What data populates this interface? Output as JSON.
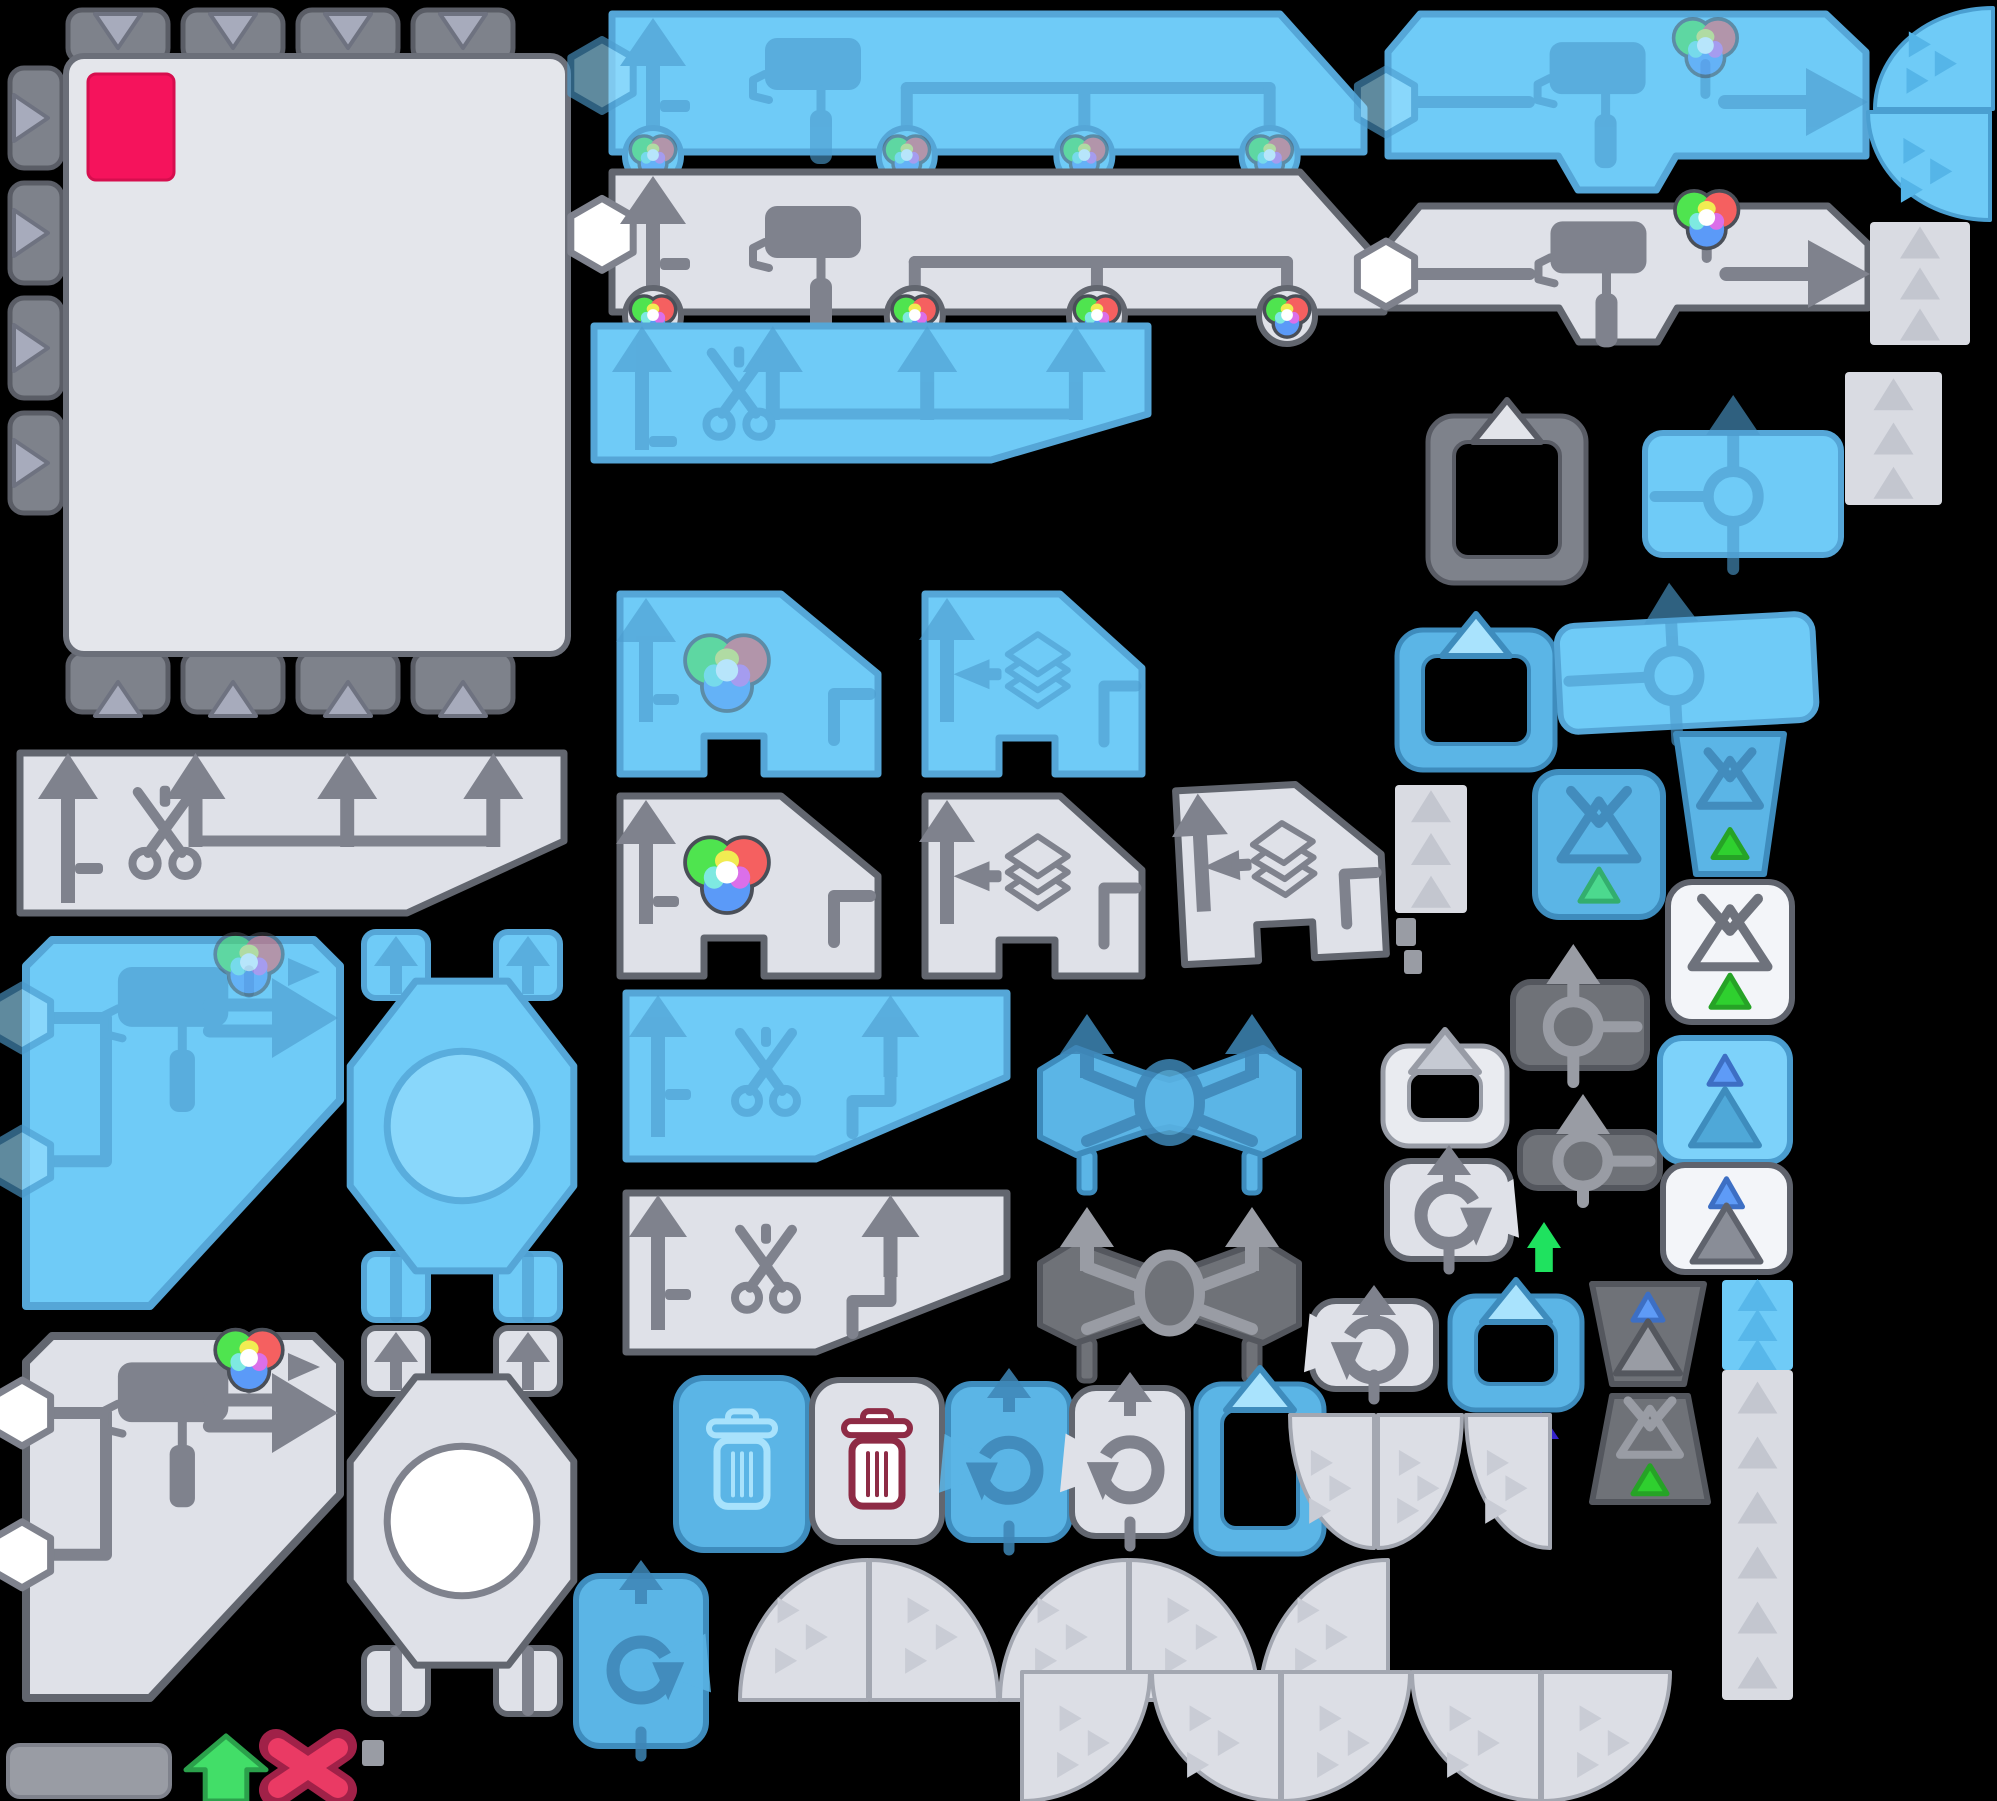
{
  "meta": {
    "kind": "game-ui-sprite-atlas",
    "width": 1997,
    "height": 1801,
    "background": "#000000"
  },
  "palette": {
    "background": "#000000",
    "pink_swatch": "#F5135C",
    "schemes": {
      "blue": {
        "f": "#6FCBF7",
        "s": "#55A6D7",
        "i": "#4C9CCE",
        "lt": "#9ADFFF",
        "iop": 0.62
      },
      "blueMid": {
        "f": "#5BB5E6",
        "s": "#3E8CBD",
        "i": "#3E86B6",
        "lt": "#A9E3FD",
        "iop": 0.85
      },
      "gray": {
        "f": "#DFE1E8",
        "s": "#62666F",
        "i": "#7F828D",
        "lt": "#FFFFFF",
        "iop": 1
      },
      "dark": {
        "f": "#6F7278",
        "s": "#54575E",
        "i": "#999CA4",
        "lt": "#C9CCD3",
        "iop": 1
      },
      "white": {
        "f": "#F3F5F9",
        "s": "#5F636D",
        "i": "#6E727C",
        "lt": "#FFFFFF",
        "iop": 1
      },
      "light": {
        "f": "#E9EBF0",
        "s": "#989CA6",
        "i": "#B7BAC3",
        "lt": "#C6CAD3",
        "iop": 1
      },
      "grayTab": {
        "f": "#7E828B",
        "s": "#595C65",
        "i": "#B9BCC7",
        "lt": "#E2E4EA",
        "iop": 1
      }
    },
    "frame": {
      "tab": "#7E828B",
      "tabStroke": "#5A5D66",
      "triangle": "#A7ABBC",
      "panel": "#E4E6EB",
      "panelStroke": "#6B6F79"
    },
    "rgb": {
      "green": "#4FE44F",
      "red": "#F56060",
      "blue": "#5B9AF8",
      "yellow": "#F1EC52",
      "magenta": "#DB6FE9",
      "cyan": "#7EE9E1",
      "white": "#FFFFFF",
      "outline": "#4A4F58"
    },
    "accents": {
      "green": "#42DE68",
      "greenDark": "#2BA04B",
      "springGreen": "#1FE25F",
      "indigo": "#3524CC",
      "redX": "#EA3A64",
      "redXDark": "#A02148",
      "maroon": "#8E2B45",
      "triGreen": "#2FD02F",
      "triGreenDark": "#26A326",
      "triTeal": "#4CD98E",
      "triTealDark": "#33AE6E",
      "triBlue": "#5E9BF7",
      "triBlueDark": "#3D6FC4"
    },
    "fans": {
      "grayFill": "#DCDEE5",
      "grayStroke": "#A3A7B1",
      "grayChevron": "#C9CCD5",
      "blueFill": "#6FCBF7",
      "blueStroke": "#4A9FD1",
      "blueChevron": "#55B5E8"
    },
    "slab": {
      "fill": "#999CA4",
      "stroke": "#7F828C"
    }
  },
  "icons": [
    "paint-roller-icon",
    "scissors-icon",
    "rgb-ball-icon",
    "layers-icon",
    "clipboard-icon",
    "trash-icon",
    "undo-icon",
    "redo-icon",
    "up-arrow-icon",
    "right-arrow-icon",
    "hexagon-socket-icon",
    "x-mark-icon",
    "triangle-icon",
    "ring-icon"
  ],
  "sprites": [
    {
      "name": "canvas-frame",
      "type": "frame",
      "x": 8,
      "y": 8,
      "w": 566,
      "h": 715
    },
    {
      "name": "paint-strip-blue",
      "type": "rollerBanner",
      "x": 598,
      "y": 8,
      "w": 772,
      "h": 150,
      "scheme": "blue"
    },
    {
      "name": "paint-strip-gray",
      "type": "rollerBanner",
      "x": 598,
      "y": 166,
      "w": 792,
      "h": 152,
      "scheme": "gray"
    },
    {
      "name": "cut-strip-blue",
      "type": "scissorsBanner",
      "x": 584,
      "y": 318,
      "w": 572,
      "h": 150,
      "scheme": "blue"
    },
    {
      "name": "cut-strip-gray",
      "type": "scissorsBanner",
      "x": 10,
      "y": 745,
      "w": 562,
      "h": 176,
      "scheme": "gray"
    },
    {
      "name": "recolor-panel-blue",
      "type": "rgbPanel",
      "x": 586,
      "y": 586,
      "w": 300,
      "h": 196,
      "scheme": "blue"
    },
    {
      "name": "layers-panel-blue",
      "type": "layersPanel",
      "x": 895,
      "y": 586,
      "w": 255,
      "h": 196,
      "scheme": "blue"
    },
    {
      "name": "recolor-panel-gray",
      "type": "rgbPanel",
      "x": 586,
      "y": 788,
      "w": 300,
      "h": 196,
      "scheme": "gray"
    },
    {
      "name": "layers-panel-gray",
      "type": "layersPanel",
      "x": 895,
      "y": 788,
      "w": 255,
      "h": 196,
      "scheme": "gray"
    },
    {
      "name": "layers-panel-gray-b",
      "type": "layersPanel",
      "x": 1150,
      "y": 778,
      "w": 240,
      "h": 190,
      "scheme": "gray",
      "rot": -3
    },
    {
      "name": "cut-panel-blue",
      "type": "scissorsSmall",
      "x": 600,
      "y": 985,
      "w": 415,
      "h": 182,
      "scheme": "blue"
    },
    {
      "name": "cut-panel-gray",
      "type": "scissorsSmall",
      "x": 600,
      "y": 1185,
      "w": 415,
      "h": 175,
      "scheme": "gray"
    },
    {
      "name": "swap-panel-blue",
      "type": "crossPanel",
      "x": 1032,
      "y": 1012,
      "w": 275,
      "h": 185,
      "scheme": "blueMid"
    },
    {
      "name": "swap-panel-dark",
      "type": "crossPanel",
      "x": 1032,
      "y": 1205,
      "w": 275,
      "h": 180,
      "scheme": "dark"
    },
    {
      "name": "roller-panel-blue",
      "type": "rollerPanel",
      "x": 1382,
      "y": 8,
      "w": 490,
      "h": 188,
      "scheme": "blue"
    },
    {
      "name": "roller-panel-gray",
      "type": "rollerPanel",
      "x": 1382,
      "y": 200,
      "w": 492,
      "h": 148,
      "scheme": "gray"
    },
    {
      "name": "paste-frame-gray",
      "type": "clipboard",
      "x": 1428,
      "y": 398,
      "w": 158,
      "h": 185,
      "scheme": "grayTab"
    },
    {
      "name": "move-panel-blue-a",
      "type": "roundabout",
      "x": 1645,
      "y": 393,
      "w": 196,
      "h": 178,
      "scheme": "blue"
    },
    {
      "name": "paste-frame-blue-a",
      "type": "clipboard",
      "x": 1397,
      "y": 612,
      "w": 158,
      "h": 158,
      "scheme": "blueMid"
    },
    {
      "name": "move-panel-blue-b",
      "type": "roundabout",
      "x": 1558,
      "y": 580,
      "w": 256,
      "h": 162,
      "scheme": "blue",
      "rot": -3
    },
    {
      "name": "funnel-square-blue",
      "type": "funnelSquare",
      "x": 1535,
      "y": 772,
      "w": 128,
      "h": 145,
      "scheme": "blueMid",
      "tri": "teal"
    },
    {
      "name": "funnel-bucket-blue",
      "type": "bucket",
      "x": 1672,
      "y": 728,
      "w": 116,
      "h": 152,
      "scheme": "blueMid",
      "content": "funnel"
    },
    {
      "name": "funnel-square-white",
      "type": "funnelSquare",
      "x": 1668,
      "y": 882,
      "w": 124,
      "h": 140,
      "scheme": "white",
      "tri": "green"
    },
    {
      "name": "strip-c",
      "type": "strip",
      "x": 1395,
      "y": 785,
      "w": 72,
      "h": 128,
      "scheme": "gray",
      "n": 3
    },
    {
      "name": "bit-a",
      "type": "slab",
      "x": 1396,
      "y": 918,
      "w": 20,
      "h": 28
    },
    {
      "name": "bit-b",
      "type": "slab",
      "x": 1404,
      "y": 950,
      "w": 18,
      "h": 24
    },
    {
      "name": "move-panel-dark-a",
      "type": "roundabout",
      "x": 1513,
      "y": 942,
      "w": 134,
      "h": 142,
      "scheme": "dark"
    },
    {
      "name": "move-panel-dark-b",
      "type": "roundabout",
      "x": 1520,
      "y": 1092,
      "w": 140,
      "h": 112,
      "scheme": "dark"
    },
    {
      "name": "paste-frame-light",
      "type": "clipboard",
      "x": 1383,
      "y": 1028,
      "w": 124,
      "h": 118,
      "scheme": "light"
    },
    {
      "name": "tri-square-blue",
      "type": "triSquare",
      "x": 1660,
      "y": 1038,
      "w": 130,
      "h": 124,
      "scheme": "blue"
    },
    {
      "name": "redo-tile-gray",
      "type": "rotateTile",
      "x": 1387,
      "y": 1145,
      "w": 124,
      "h": 128,
      "scheme": "gray",
      "dir": "cw"
    },
    {
      "name": "green-arrow-small",
      "type": "blockArrow",
      "x": 1527,
      "y": 1222,
      "w": 34,
      "h": 50,
      "color": "springGreen"
    },
    {
      "name": "tri-square-white",
      "type": "triSquare",
      "x": 1663,
      "y": 1165,
      "w": 127,
      "h": 107,
      "scheme": "white"
    },
    {
      "name": "undo-tile-gray-b",
      "type": "rotateTile",
      "x": 1312,
      "y": 1285,
      "w": 124,
      "h": 118,
      "scheme": "gray",
      "dir": "ccw"
    },
    {
      "name": "paste-frame-blue-b",
      "type": "clipboard",
      "x": 1450,
      "y": 1278,
      "w": 132,
      "h": 132,
      "scheme": "blueMid"
    },
    {
      "name": "tri-bucket-dark",
      "type": "bucket",
      "x": 1588,
      "y": 1278,
      "w": 120,
      "h": 112,
      "scheme": "dark",
      "content": "tri"
    },
    {
      "name": "funnel-bucket-dark",
      "type": "bucket",
      "x": 1588,
      "y": 1390,
      "w": 124,
      "h": 118,
      "scheme": "dark",
      "content": "funnel",
      "flip": true
    },
    {
      "name": "indigo-arrow",
      "type": "blockArrow",
      "x": 1523,
      "y": 1412,
      "w": 36,
      "h": 52,
      "color": "indigo"
    },
    {
      "name": "strip-blue",
      "type": "strip",
      "x": 1722,
      "y": 1280,
      "w": 71,
      "h": 90,
      "scheme": "blue",
      "n": 3
    },
    {
      "name": "strip-tall",
      "type": "strip",
      "x": 1722,
      "y": 1370,
      "w": 71,
      "h": 330,
      "scheme": "gray",
      "n": 6
    },
    {
      "name": "fan-blue-a",
      "type": "fan",
      "x": 1875,
      "y": 8,
      "w": 118,
      "h": 101,
      "scheme": "blue",
      "corner": "br"
    },
    {
      "name": "fan-blue-b",
      "type": "fan",
      "x": 1868,
      "y": 112,
      "w": 122,
      "h": 108,
      "scheme": "blue",
      "corner": "tr"
    },
    {
      "name": "strip-a",
      "type": "strip",
      "x": 1870,
      "y": 222,
      "w": 100,
      "h": 123,
      "scheme": "gray",
      "n": 3
    },
    {
      "name": "strip-b",
      "type": "strip",
      "x": 1845,
      "y": 372,
      "w": 97,
      "h": 133,
      "scheme": "gray",
      "n": 3
    },
    {
      "name": "painter-panel-blue",
      "type": "bigRollerPanel",
      "x": 18,
      "y": 932,
      "w": 330,
      "h": 382,
      "scheme": "blue"
    },
    {
      "name": "painter-panel-gray",
      "type": "bigRollerPanel",
      "x": 18,
      "y": 1328,
      "w": 330,
      "h": 378,
      "scheme": "gray"
    },
    {
      "name": "mixer-machine-blue",
      "type": "octagonMachine",
      "x": 352,
      "y": 930,
      "w": 220,
      "h": 392,
      "scheme": "blue"
    },
    {
      "name": "mixer-machine-gray",
      "type": "octagonMachine",
      "x": 352,
      "y": 1326,
      "w": 220,
      "h": 390,
      "scheme": "gray"
    },
    {
      "name": "trash-tile-blue",
      "type": "trashTile",
      "x": 676,
      "y": 1370,
      "w": 132,
      "h": 188,
      "scheme": "blueMid"
    },
    {
      "name": "trash-tile-gray",
      "type": "trashTile",
      "x": 812,
      "y": 1372,
      "w": 130,
      "h": 178,
      "scheme": "gray"
    },
    {
      "name": "undo-tile-blue",
      "type": "rotateTile",
      "x": 948,
      "y": 1368,
      "w": 122,
      "h": 186,
      "scheme": "blueMid",
      "dir": "ccw"
    },
    {
      "name": "undo-tile-gray",
      "type": "rotateTile",
      "x": 1072,
      "y": 1372,
      "w": 116,
      "h": 178,
      "scheme": "gray",
      "dir": "ccw"
    },
    {
      "name": "paste-frame-blue-c",
      "type": "clipboard",
      "x": 1196,
      "y": 1366,
      "w": 128,
      "h": 188,
      "scheme": "blueMid"
    },
    {
      "name": "redo-tile-blue",
      "type": "rotateTile",
      "x": 576,
      "y": 1560,
      "w": 130,
      "h": 200,
      "scheme": "blueMid",
      "dir": "cw"
    },
    {
      "name": "fan-1",
      "type": "fan",
      "x": 740,
      "y": 1560,
      "w": 128,
      "h": 140,
      "scheme": "gray",
      "corner": "br"
    },
    {
      "name": "fan-2",
      "type": "fan",
      "x": 870,
      "y": 1560,
      "w": 128,
      "h": 140,
      "scheme": "gray",
      "corner": "bl"
    },
    {
      "name": "fan-3",
      "type": "fan",
      "x": 1000,
      "y": 1560,
      "w": 128,
      "h": 140,
      "scheme": "gray",
      "corner": "br"
    },
    {
      "name": "fan-4",
      "type": "fan",
      "x": 1130,
      "y": 1560,
      "w": 128,
      "h": 140,
      "scheme": "gray",
      "corner": "bl"
    },
    {
      "name": "fan-5",
      "type": "fan",
      "x": 1260,
      "y": 1560,
      "w": 128,
      "h": 140,
      "scheme": "gray",
      "corner": "br"
    },
    {
      "name": "fan-6",
      "type": "fan",
      "x": 1290,
      "y": 1415,
      "w": 84,
      "h": 133,
      "scheme": "gray",
      "corner": "tr"
    },
    {
      "name": "fan-7",
      "type": "fan",
      "x": 1378,
      "y": 1415,
      "w": 84,
      "h": 133,
      "scheme": "gray",
      "corner": "tl"
    },
    {
      "name": "fan-8",
      "type": "fan",
      "x": 1466,
      "y": 1415,
      "w": 84,
      "h": 133,
      "scheme": "gray",
      "corner": "tr"
    },
    {
      "name": "fan-9",
      "type": "fan",
      "x": 1022,
      "y": 1672,
      "w": 128,
      "h": 129,
      "scheme": "gray",
      "corner": "tl"
    },
    {
      "name": "fan-10",
      "type": "fan",
      "x": 1152,
      "y": 1672,
      "w": 128,
      "h": 129,
      "scheme": "gray",
      "corner": "tr"
    },
    {
      "name": "fan-11",
      "type": "fan",
      "x": 1282,
      "y": 1672,
      "w": 128,
      "h": 129,
      "scheme": "gray",
      "corner": "tl"
    },
    {
      "name": "fan-12",
      "type": "fan",
      "x": 1412,
      "y": 1672,
      "w": 128,
      "h": 129,
      "scheme": "gray",
      "corner": "tr"
    },
    {
      "name": "fan-13",
      "type": "fan",
      "x": 1542,
      "y": 1672,
      "w": 128,
      "h": 129,
      "scheme": "gray",
      "corner": "tl"
    },
    {
      "name": "gray-slab",
      "type": "slab",
      "x": 8,
      "y": 1745,
      "w": 162,
      "h": 52
    },
    {
      "name": "green-arrow-large",
      "type": "blockArrow",
      "x": 186,
      "y": 1736,
      "w": 80,
      "h": 65,
      "color": "green"
    },
    {
      "name": "red-x",
      "type": "xmark",
      "x": 262,
      "y": 1732,
      "w": 92,
      "h": 72
    },
    {
      "name": "bit-c",
      "type": "slab",
      "x": 362,
      "y": 1740,
      "w": 22,
      "h": 26
    }
  ]
}
